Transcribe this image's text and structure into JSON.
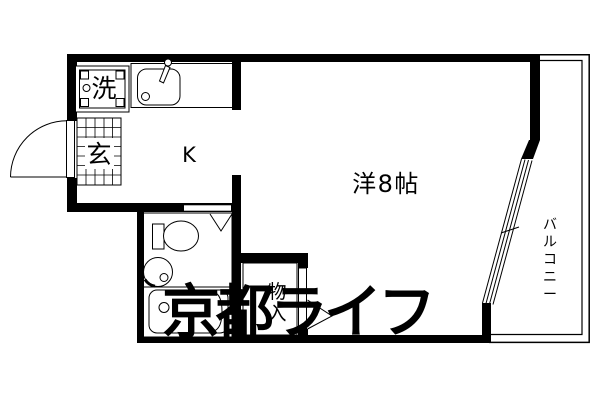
{
  "floorplan": {
    "labels": {
      "kitchen": "K",
      "main_room": "洋8帖",
      "balcony": "バルコニー",
      "storage": "物入",
      "entrance": "玄",
      "laundry": "洗"
    },
    "watermark": "京都ライフ",
    "colors": {
      "line": "#000000",
      "background": "#ffffff",
      "watermark": "#d3d3d3"
    }
  }
}
